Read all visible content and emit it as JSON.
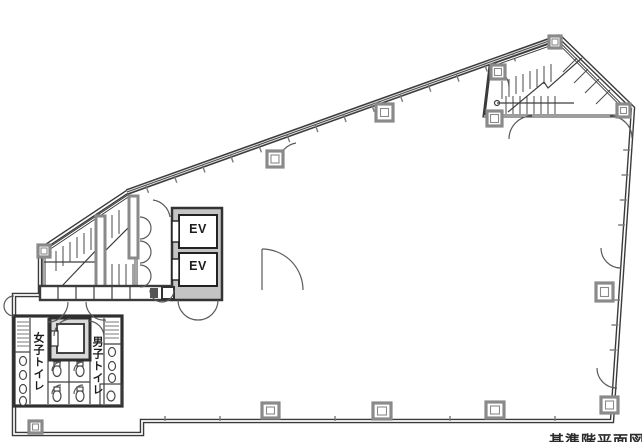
{
  "page": {
    "background": "#ffffff",
    "caption": "基準階平面図"
  },
  "floorplan": {
    "elevators": {
      "ev1": "EV",
      "ev2": "EV"
    },
    "toilets": {
      "womens": "女子トイレ",
      "mens": "男子トイレ"
    },
    "colors": {
      "wall": "#3b3b3b",
      "column_gray": "#8a8a8a",
      "shaft_fill": "#d9d9d9",
      "ev_block_fill": "#c4c4c4",
      "text": "#1c1c1c"
    }
  }
}
